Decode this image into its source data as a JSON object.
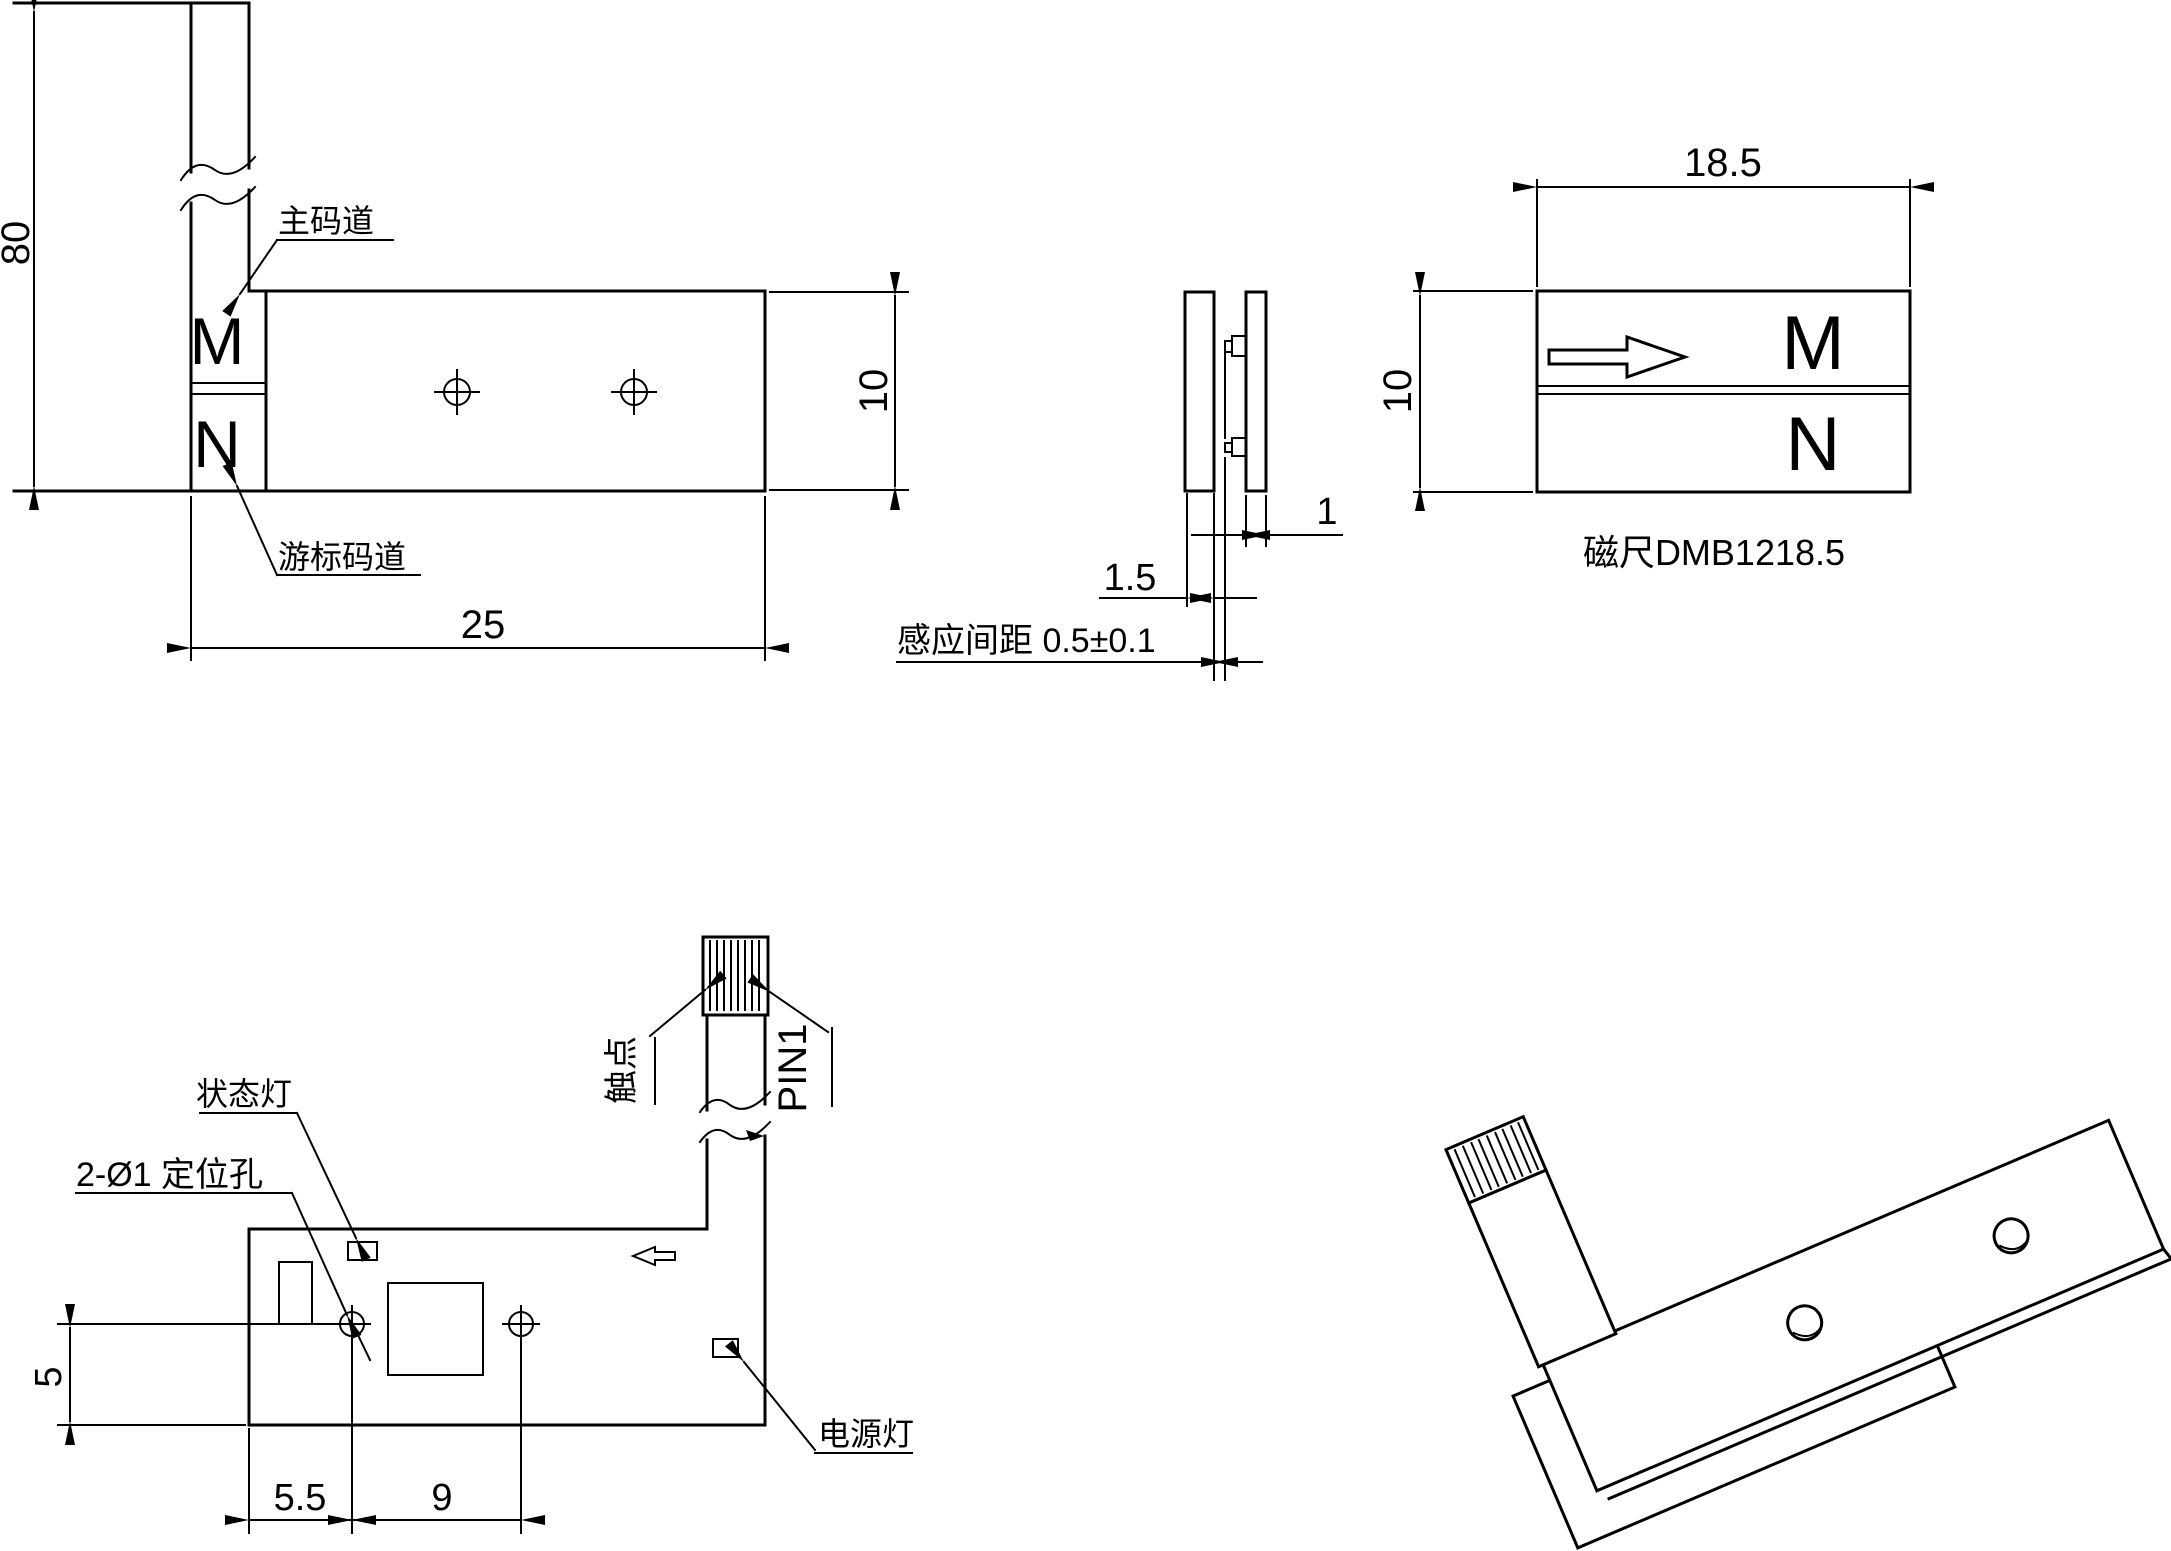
{
  "colors": {
    "line": "#000000",
    "background": "#ffffff"
  },
  "views": {
    "scale_plan": {
      "dim_total_length": "80",
      "dim_body_length": "25",
      "dim_width": "10",
      "label_main_track": "主码道",
      "label_vernier_track": "游标码道",
      "pole_m": "M",
      "pole_n": "N"
    },
    "scale_side": {
      "dim_pcb_thickness": "1",
      "dim_scale_thickness": "1.5",
      "dim_sensing_gap": "感应间距 0.5±0.1"
    },
    "magnet_strip": {
      "dim_length": "18.5",
      "dim_width": "10",
      "pole_m": "M",
      "pole_n": "N",
      "caption": "磁尺DMB1218.5"
    },
    "sensor_pcb": {
      "label_status_led": "状态灯",
      "label_locating_holes": "2-Ø1 定位孔",
      "label_contacts": "触点",
      "label_pin1": "PIN1",
      "label_power_led": "电源灯",
      "dim_edge_to_hole": "5.5",
      "dim_hole_spacing": "9",
      "dim_hole_to_bottom": "5"
    }
  }
}
